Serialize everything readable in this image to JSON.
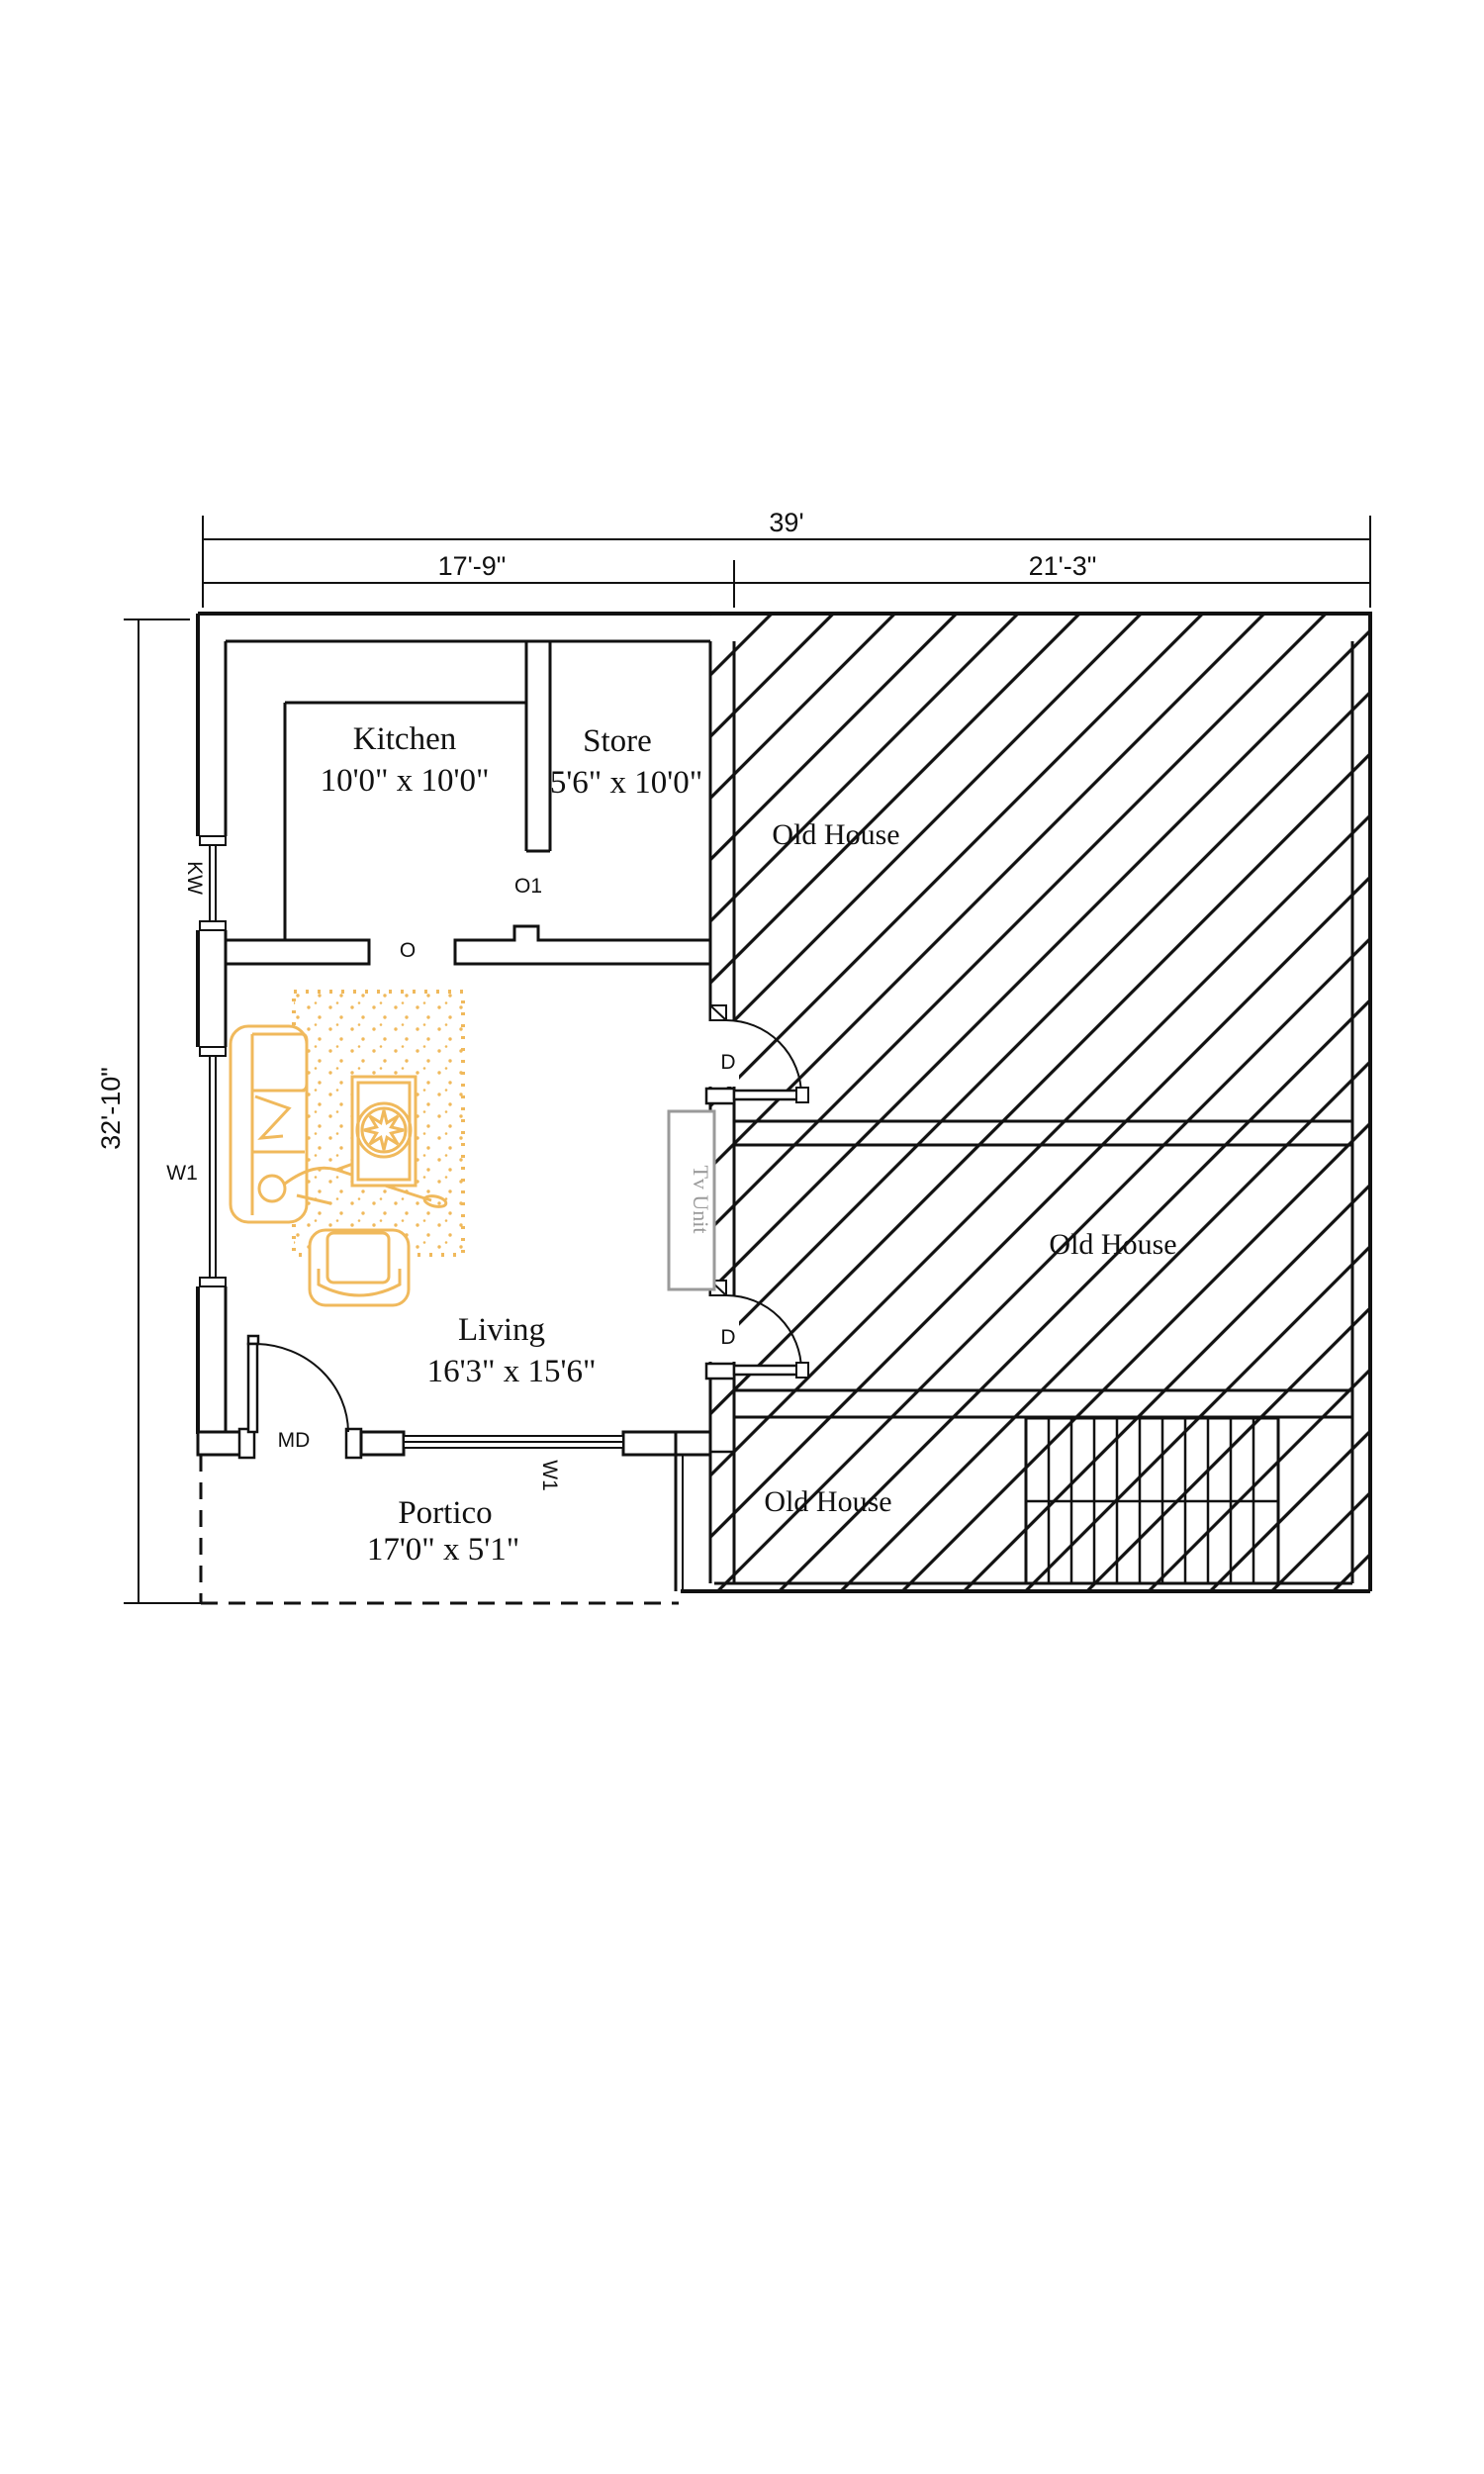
{
  "plan": {
    "dimensions": {
      "top_total": "39'",
      "top_left": "17'-9\"",
      "top_right": "21'-3\"",
      "left_height": "32'-10\""
    },
    "rooms": {
      "kitchen": {
        "name": "Kitchen",
        "size": "10'0\" x 10'0\""
      },
      "store": {
        "name": "Store",
        "size": "5'6\" x 10'0\""
      },
      "living": {
        "name": "Living",
        "size": "16'3\" x 15'6\""
      },
      "portico": {
        "name": "Portico",
        "size": "17'0\" x 5'1\""
      },
      "old_house_top": {
        "name": "Old House"
      },
      "old_house_middle": {
        "name": "Old House"
      },
      "old_house_bottom": {
        "name": "Old House"
      }
    },
    "labels": {
      "kitchen_window": "KW",
      "window_left": "W1",
      "window_bottom": "W1",
      "main_door": "MD",
      "opening": "O",
      "opening_1": "O1",
      "door_top": "D",
      "door_bottom": "D",
      "tv_unit": "Tv Unit"
    },
    "colors": {
      "line": "#111111",
      "furniture": "#f0b95c",
      "tv_unit_gray": "#9a9a9a"
    }
  }
}
